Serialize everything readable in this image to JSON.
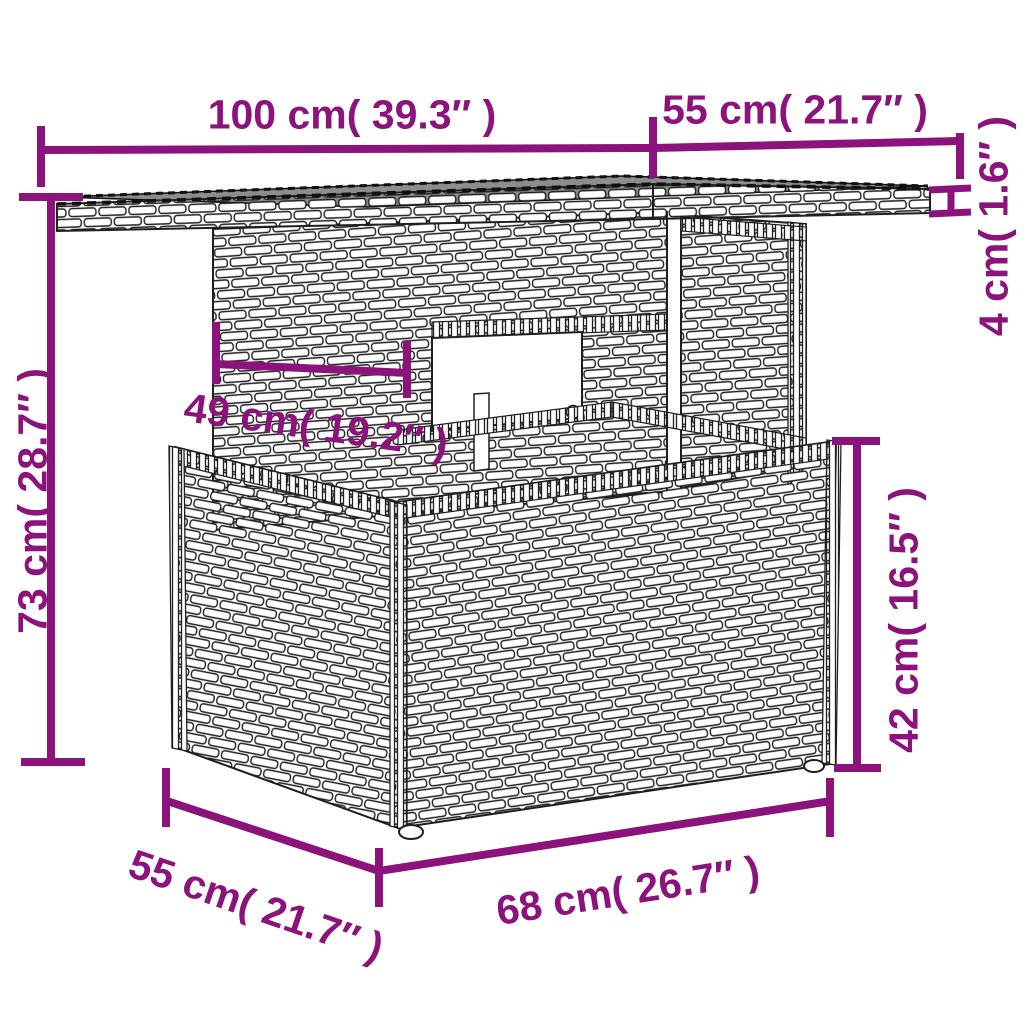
{
  "colors": {
    "dimension_line": "#8c127c",
    "outline": "#1f1f1f",
    "glass_top": "#8b8d8e",
    "wicker": "#ffffff",
    "background": "#ffffff"
  },
  "dimensions": {
    "top_width": {
      "text": "100 cm( 39.3″ )",
      "cm": 100,
      "inches": 39.3
    },
    "top_depth": {
      "text": "55 cm( 21.7″ )",
      "cm": 55,
      "inches": 21.7
    },
    "top_thickness": {
      "text": "4 cm( 1.6″ )",
      "cm": 4,
      "inches": 1.6
    },
    "total_height": {
      "text": "73 cm( 28.7″ )",
      "cm": 73,
      "inches": 28.7
    },
    "understructure_width": {
      "text": "49 cm( 19.2″ )",
      "cm": 49,
      "inches": 19.2
    },
    "base_height": {
      "text": "42 cm( 16.5″ )",
      "cm": 42,
      "inches": 16.5
    },
    "base_depth": {
      "text": "55 cm( 21.7″ )",
      "cm": 55,
      "inches": 21.7
    },
    "base_width": {
      "text": "68 cm( 26.7″ )",
      "cm": 68,
      "inches": 26.7
    }
  }
}
